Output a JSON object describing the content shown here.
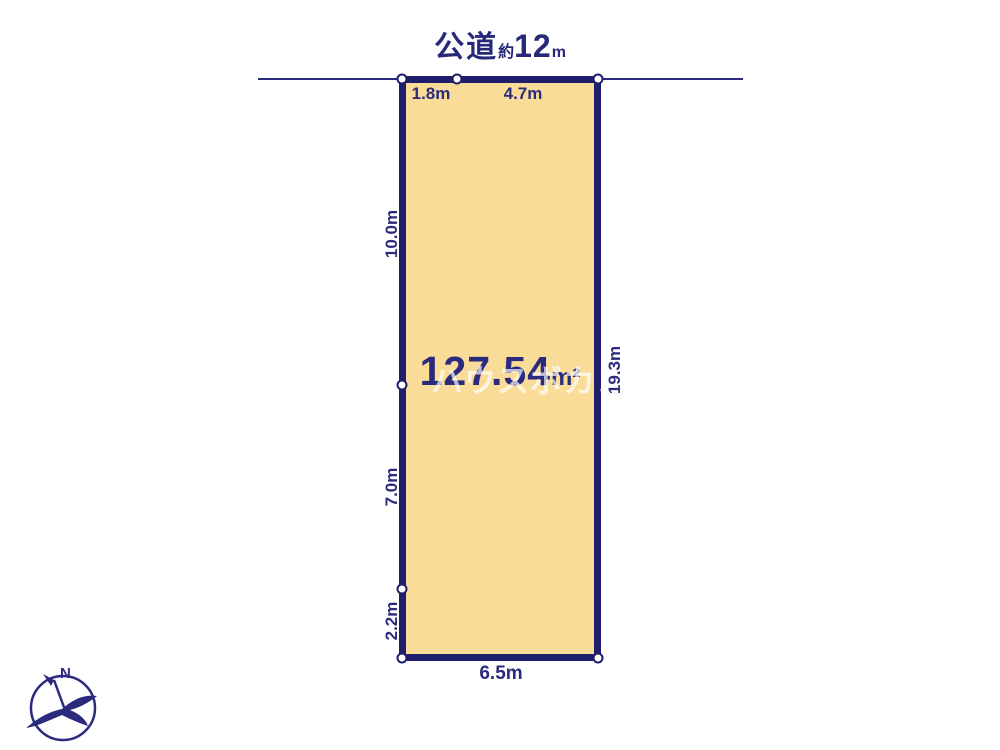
{
  "title": {
    "road_label": "公道",
    "approx_label": "約",
    "road_width_value": "12",
    "road_width_unit": "m"
  },
  "plot": {
    "area_value": "127.54",
    "area_unit": "m²",
    "watermark_text": "ハウスボカン",
    "dimensions": {
      "top_left": "1.8m",
      "top_right": "4.7m",
      "left_upper": "10.0m",
      "left_middle": "7.0m",
      "left_lower": "2.2m",
      "right_side": "19.3m",
      "bottom": "6.5m"
    },
    "colors": {
      "fill": "#F9DC97",
      "border": "#1E1E6B",
      "text": "#2B2B7E",
      "background": "#FFFFFF",
      "watermark": "rgba(255,255,255,0.68)"
    }
  },
  "compass": {
    "north_label": "N"
  }
}
